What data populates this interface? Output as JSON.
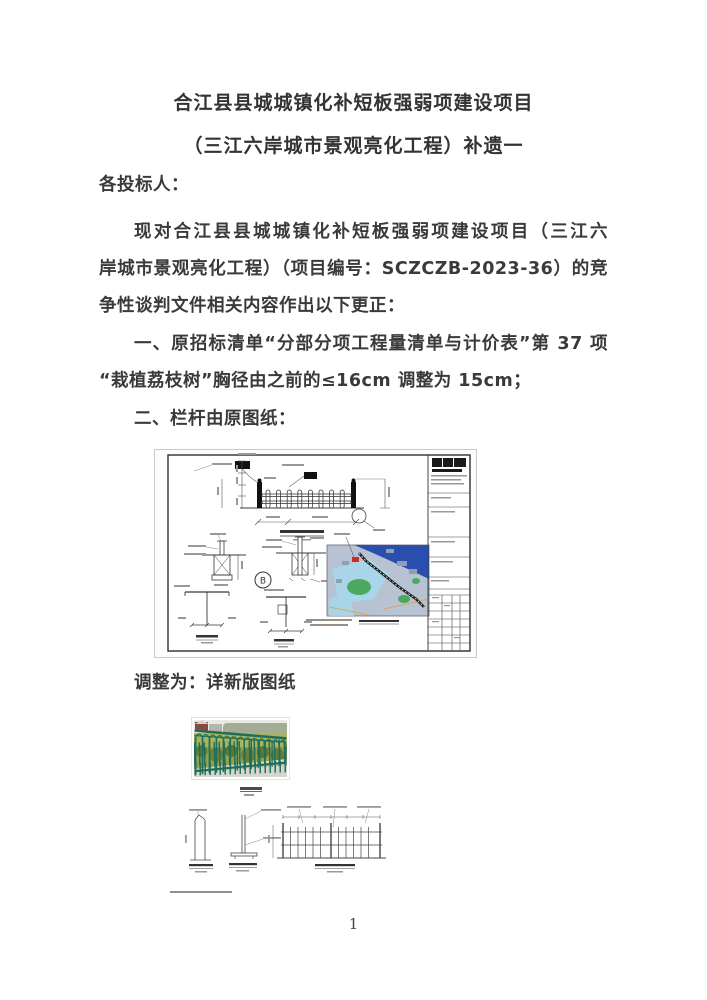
{
  "document": {
    "title_line1": "合江县县城城镇化补短板强弱项建设项目",
    "title_line2": "（三江六岸城市景观亮化工程）补遗一",
    "salutation": "各投标人：",
    "paragraph_lines": [
      "现对合江县县城城镇化补短板强弱项建设项目（三江六",
      "岸城市景观亮化工程）（项目编号：SCZCZB-2023-36）的竞",
      "争性谈判文件相关内容作出以下更正："
    ],
    "item1_lines": [
      "一、原招标清单“分部分项工程量清单与计价表”第 37 项",
      "“栽植荔枝树”胸径由之前的≤16cm 调整为 15cm；"
    ],
    "item2": "二、栏杆由原图纸：",
    "adjustment_line": "调整为：详新版图纸",
    "page_number": "1"
  },
  "figures": {
    "original_drawing": {
      "section_detail_label": "B"
    },
    "colors": {
      "fence_photo_green": "#1f6f58",
      "map_base": "#b7c3d2",
      "map_river": "#2a4fae",
      "map_water": "#a6d6e8",
      "map_green": "#4da85f",
      "marker_red": "#cc2a22",
      "route": "#1a1a1a"
    }
  }
}
